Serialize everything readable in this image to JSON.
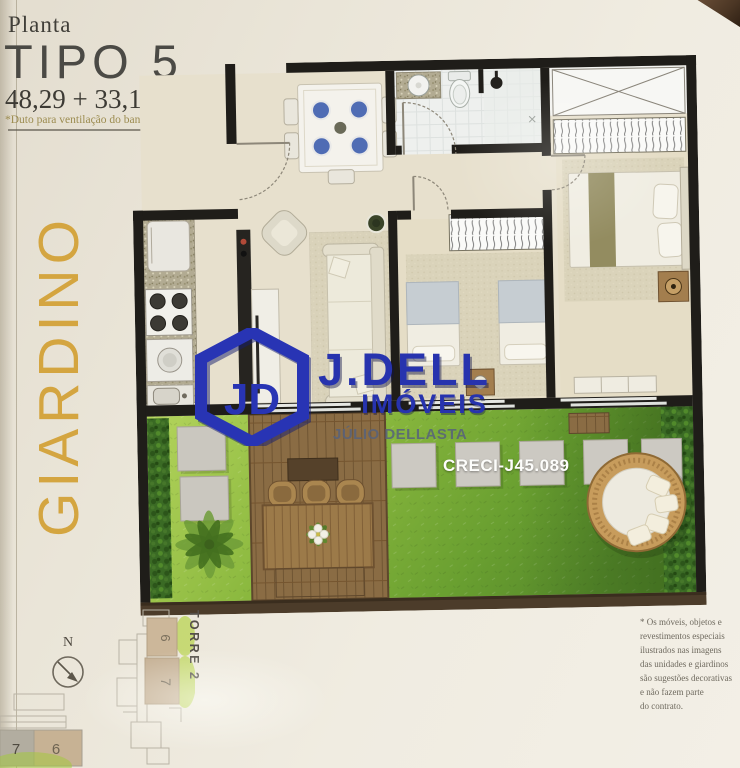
{
  "header": {
    "kicker": "Planta",
    "title": "TIPO 5",
    "area": "48,29 + 33,16m²",
    "note": "*Duto para ventilação do banheiro"
  },
  "side_label": "GIARDINO",
  "watermark": {
    "logo_monogram": "JD",
    "name": "J.DELL",
    "category": "IMÓVEIS",
    "agent": "JÚLIO DELLASTA",
    "license": "CRECI-J45.089",
    "brand_blue": "#2733ae"
  },
  "compass": {
    "north_label": "N"
  },
  "keyplan_torre": {
    "label": "TORRE 2",
    "unit_top": "6",
    "unit_bottom": "7"
  },
  "keyplan_corner": {
    "unit_left": "7",
    "unit_right": "6"
  },
  "disclaimer": {
    "lines": [
      "* Os móveis, objetos e",
      "revestimentos especiais",
      "ilustrados nas imagens",
      "das unidades e giardinos",
      "são sugestões decorativas",
      "e não fazem parte",
      "do contrato."
    ]
  },
  "plan_colors": {
    "wall": "#1f1d19",
    "floor": "#e7e0cd",
    "grass_light": "#b4d45c",
    "grass_dark": "#55872a",
    "deck_wood": "#8a6c44",
    "accent_gold": "#d4a540",
    "garden_border": "#4c3c2a"
  }
}
